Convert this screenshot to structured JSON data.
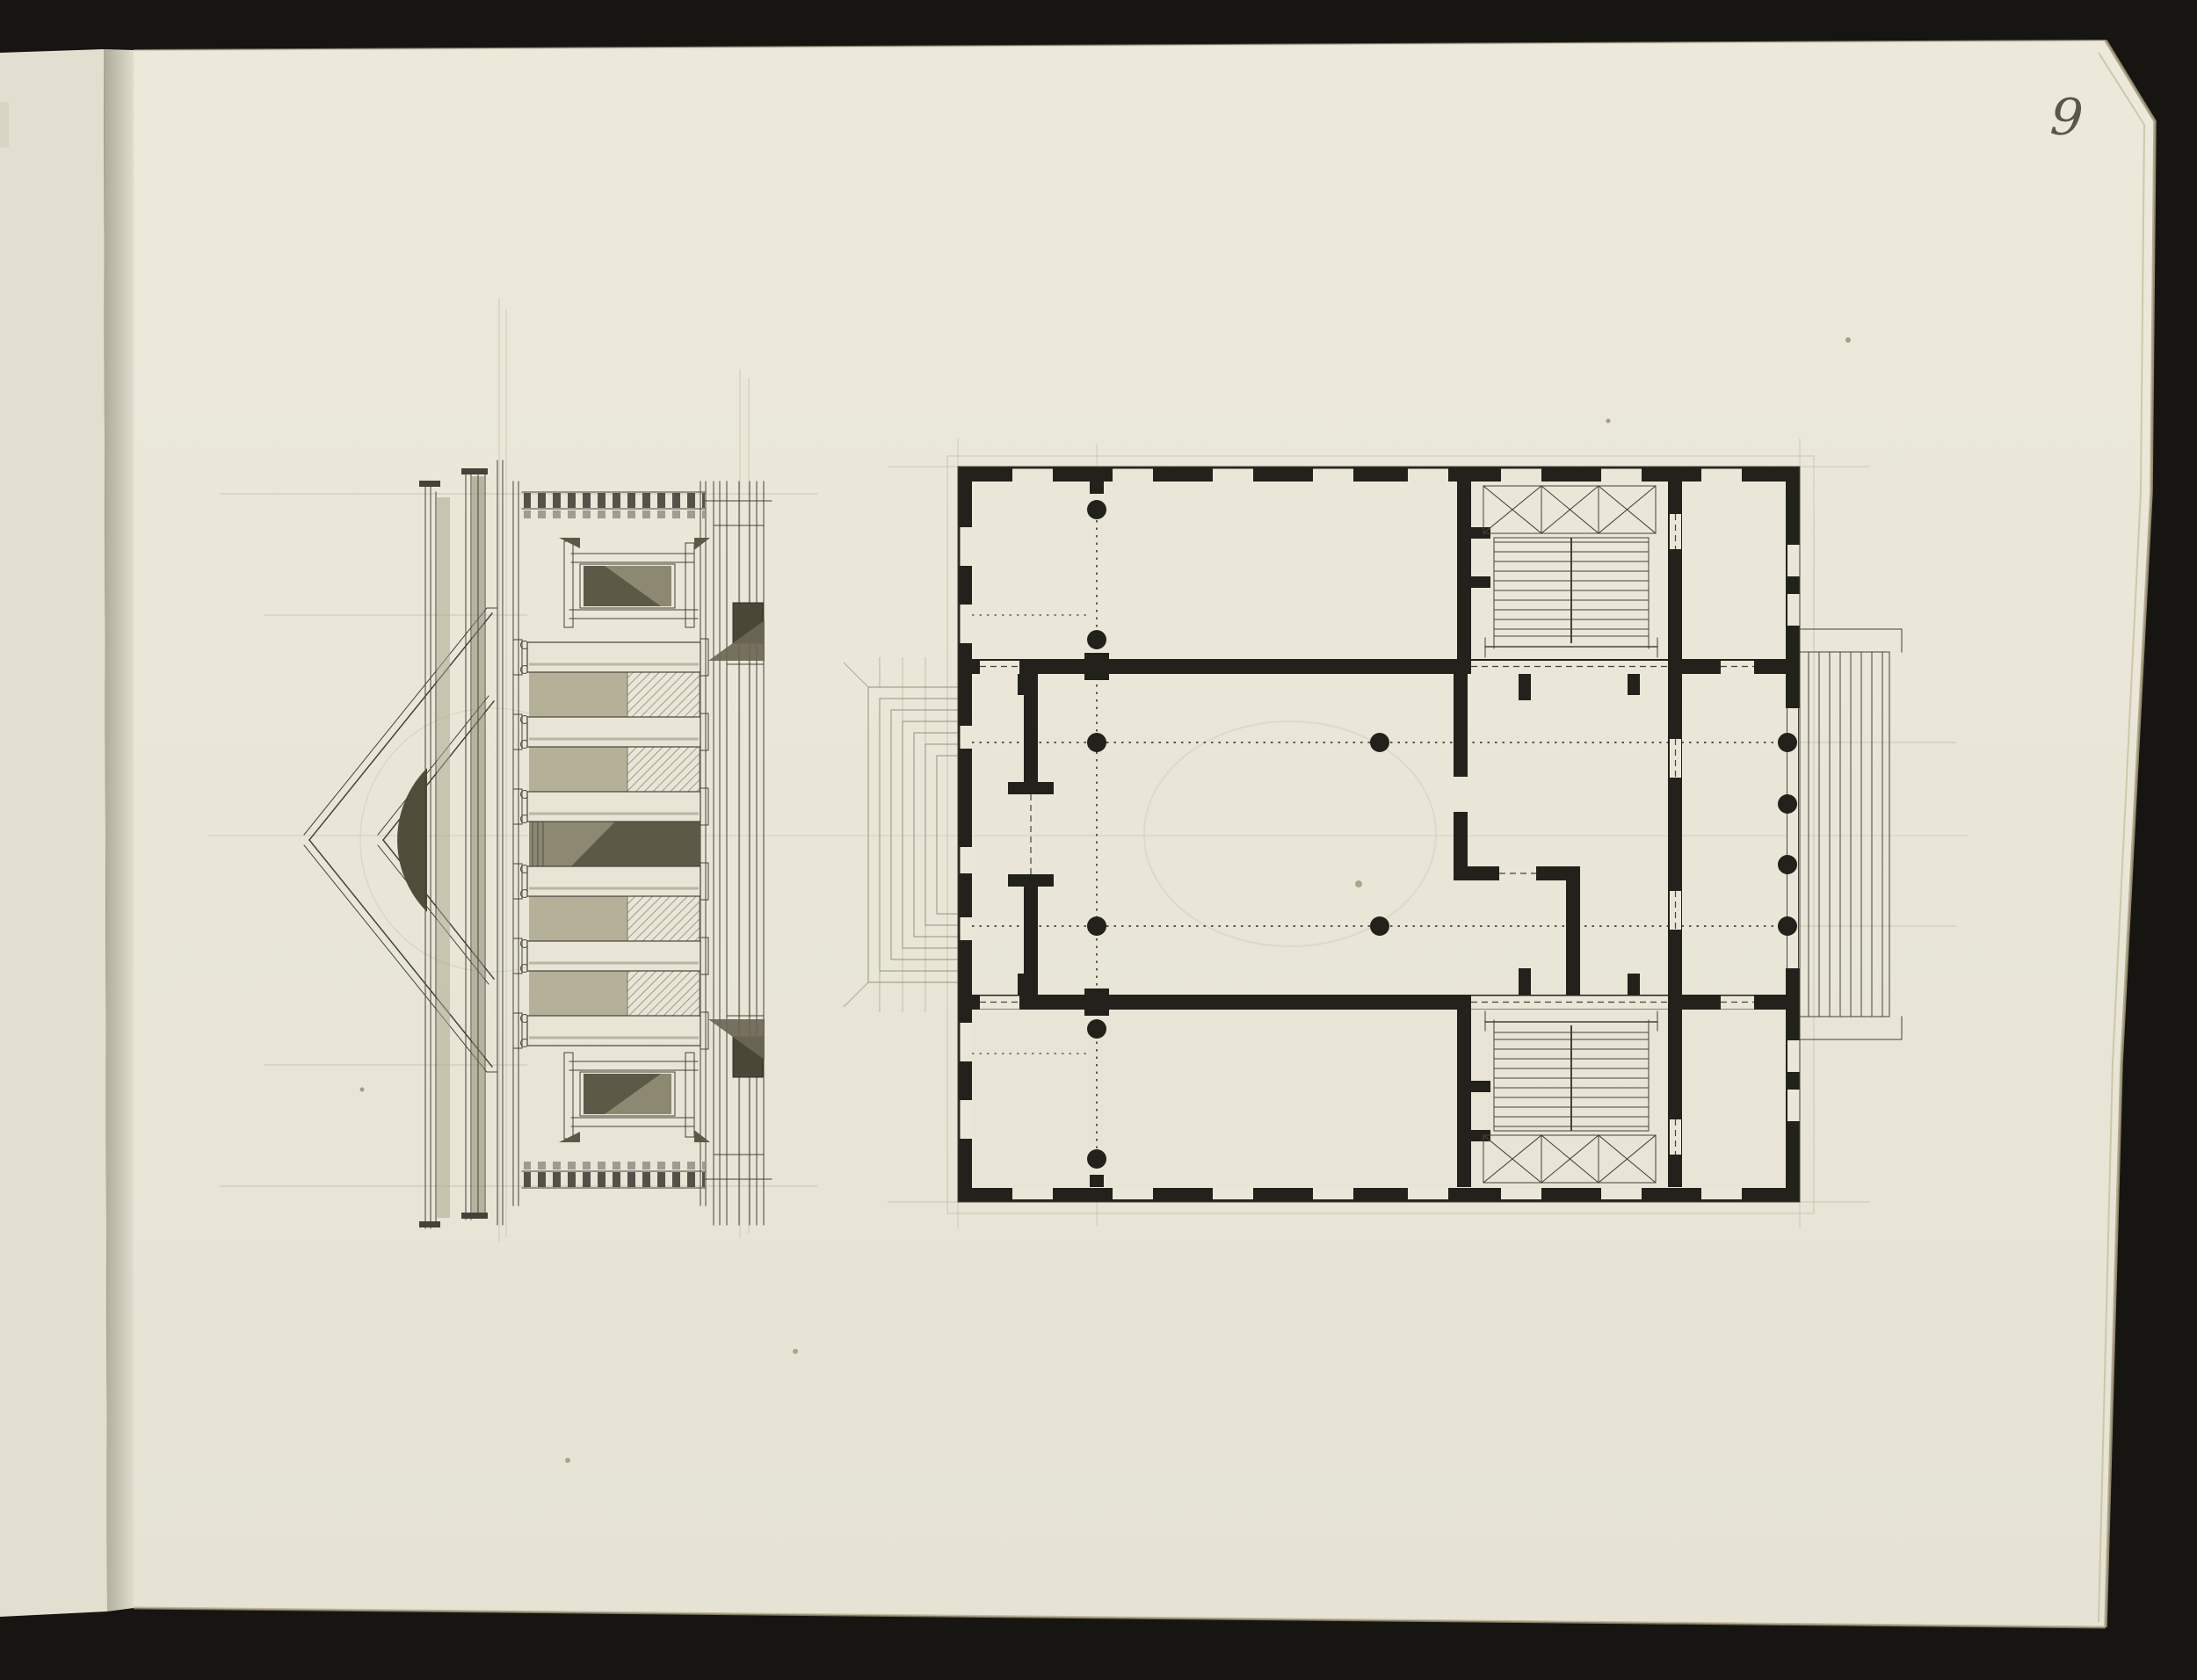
{
  "page": {
    "number": "9"
  },
  "colors": {
    "backdrop": "#171512",
    "paper": "#eae7d8",
    "paper_prev": "#e2dfd0",
    "gutter": "#b2b09d",
    "page_edge": "#a89e7f",
    "ink": "#45423a",
    "ink_dark": "#22211b",
    "pencil": "#bab6a2",
    "wash_light": "#aba78e",
    "wash_mid": "#8c8871",
    "wash_dark": "#5c5946",
    "lunette": "#504d3b",
    "handwriting": "#5a564c"
  }
}
